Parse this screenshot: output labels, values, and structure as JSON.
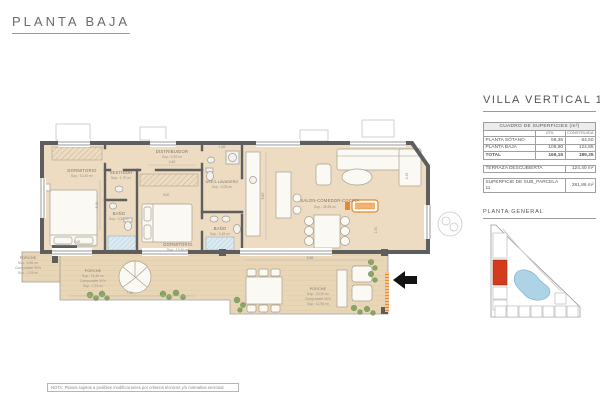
{
  "page": {
    "title": "PLANTA BAJA",
    "note": "NOTA: Planos sujetos a posibles modificaciones por criterios técnicos y/o normativa sectorial."
  },
  "panel": {
    "title": "VILLA VERTICAL 11",
    "table": {
      "title": "CUADRO DE SUPERFICIES (m²)",
      "col_util": "ÚTIL",
      "col_construida": "CONSTRUIDA",
      "rows": [
        {
          "label": "PLANTA SÓTANO",
          "util": "58,35",
          "construida": "64,50"
        },
        {
          "label": "PLANTA BAJA",
          "util": "108,80",
          "construida": "124,85"
        },
        {
          "label": "TOTAL",
          "util": "166,15",
          "construida": "189,35"
        }
      ]
    },
    "terraza": {
      "label": "TERRAZA DESCUBIERTA",
      "value": "124,40 m²"
    },
    "parcela": {
      "label": "SUPERFICIE DE SUB_PARCELA 11",
      "value": "281,86 m²"
    },
    "site_title": "PLANTA GENERAL"
  },
  "plan": {
    "rooms": [
      {
        "name": "DORMITORIO",
        "sup": "Sup.: 10,40 m²"
      },
      {
        "name": "VESTIDOR",
        "sup": "Sup.: 1,70 m²"
      },
      {
        "name": "DISTRIBUIDOR",
        "sup": "Sup.: 4,92 m²"
      },
      {
        "name": "BAÑO",
        "sup": "Sup.: 3,52 m²"
      },
      {
        "name": "DORMITORIO",
        "sup": "Sup.: 13,60 m²"
      },
      {
        "name": "ASEO-LAVADERO",
        "sup": "Sup.: 3,05 m²"
      },
      {
        "name": "BAÑO",
        "sup": "Sup.: 3,45 m²"
      },
      {
        "name": "SALON-COMEDOR-COCINA",
        "sup": "Sup.: 38,85 m²"
      }
    ],
    "porches": [
      {
        "name": "PORCHE",
        "sup": "Sup.: 5,85 m²",
        "computable": "Computable 50%",
        "sup50": "Sup.: 2,93 m²"
      },
      {
        "name": "PORCHE",
        "sup": "Sup.: 14,46 m²",
        "computable": "Computable 50%",
        "sup50": "Sup.: 7,23 m²"
      },
      {
        "name": "PORCHE",
        "sup": "Sup.: 23,90 m²",
        "computable": "Computable 50%",
        "sup50": "Sup.: 11,95 m²"
      }
    ],
    "dims": [
      "3.00",
      "5.19",
      "4.40",
      "3.00",
      "1.55",
      "9.40",
      "3.19",
      "1.91",
      "6.88",
      "7.20"
    ]
  }
}
